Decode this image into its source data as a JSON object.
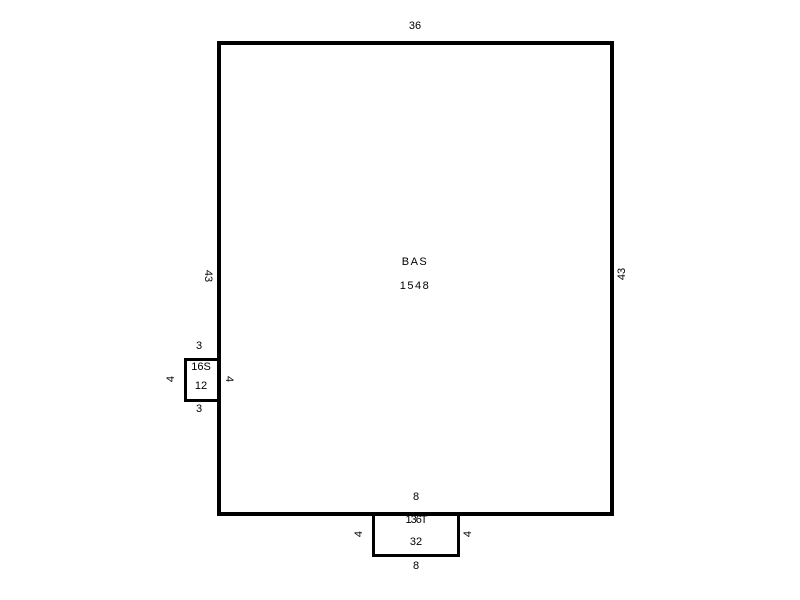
{
  "sketch": {
    "background_color": "#ffffff",
    "line_color": "#000000",
    "areas": [
      {
        "id": "bas",
        "code": "BAS",
        "area": "1548",
        "dims": {
          "top": "36",
          "left": "43",
          "right": "43"
        }
      },
      {
        "id": "left-extension",
        "code": "16S",
        "area": "12",
        "dims": {
          "top": "3",
          "bottom": "3",
          "left": "4",
          "right": "4"
        }
      },
      {
        "id": "bottom-extension",
        "code": "136T",
        "area": "32",
        "dims": {
          "top": "8",
          "bottom": "8",
          "left": "4",
          "right": "4"
        }
      }
    ]
  }
}
